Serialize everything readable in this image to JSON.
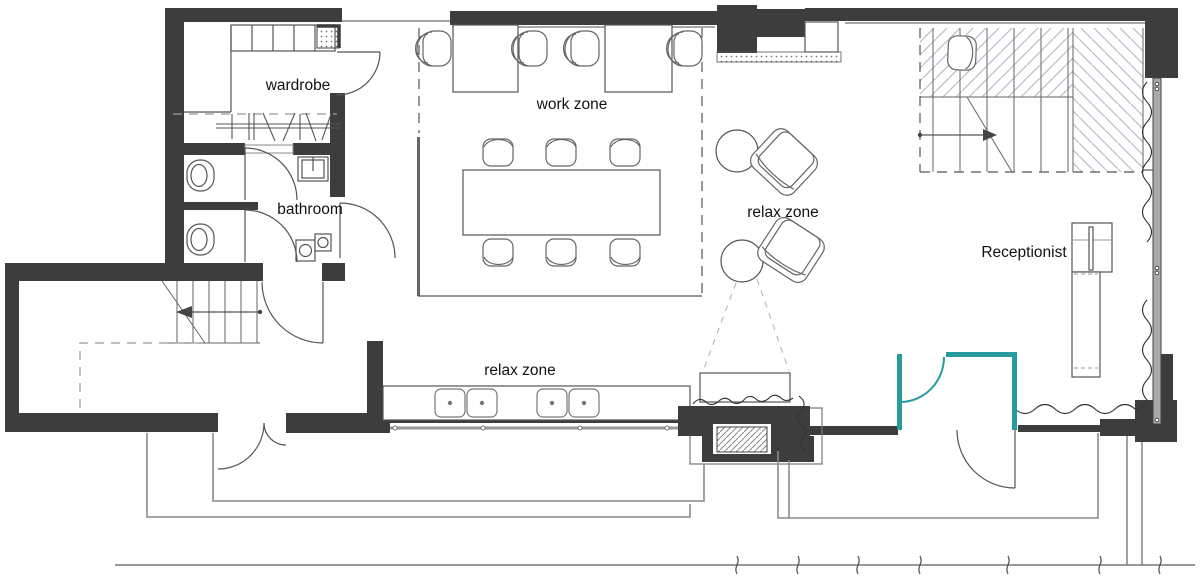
{
  "title": "Office floor plan",
  "labels": {
    "wardrobe": "wardrobe",
    "bathroom": "bathroom",
    "work_zone": "work zone",
    "relax_zone_lounge": "relax zone",
    "relax_zone_bench": "relax zone",
    "receptionist": "Receptionist"
  },
  "colors": {
    "wall": "#3d3d3d",
    "line": "#555555",
    "light_line": "#8a8a8a",
    "stair_hatch": "#bdbecb",
    "accent_teal": "#279b9d",
    "text": "#111111",
    "background": "#ffffff"
  }
}
